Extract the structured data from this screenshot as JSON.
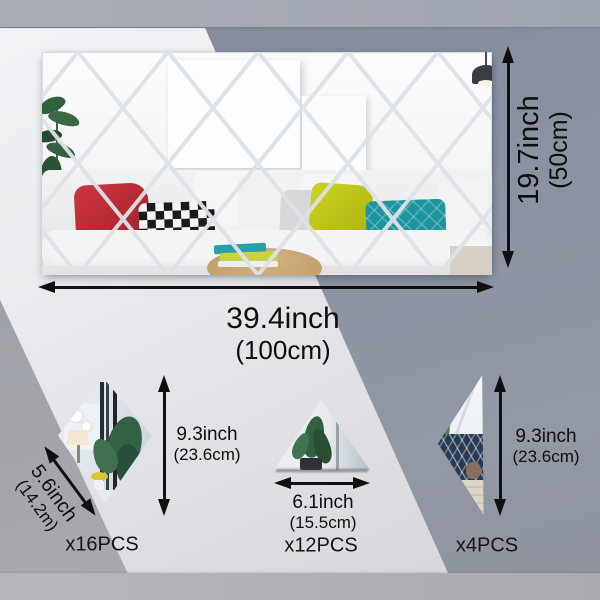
{
  "product": {
    "main_mirror": {
      "width_label": "39.4inch",
      "width_metric": "(100cm)",
      "height_label": "19.7inch",
      "height_metric": "(50cm)"
    },
    "pieces": [
      {
        "shape": "diamond",
        "edge_label": "5.6inch",
        "edge_metric": "(14.2m)",
        "height_label": "9.3inch",
        "height_metric": "(23.6cm)",
        "count": "x16PCS"
      },
      {
        "shape": "triangle",
        "base_label": "6.1inch",
        "base_metric": "(15.5cm)",
        "count": "x12PCS"
      },
      {
        "shape": "half-diamond",
        "height_label": "9.3inch",
        "height_metric": "(23.6cm)",
        "count": "x4PCS"
      }
    ]
  },
  "colors": {
    "bg_top_band": "#a7abb4",
    "bg_bottom_band": "#b0b2b6",
    "bg_light": "#e7e9ed",
    "bg_gray_blue": "#8b92a2",
    "bg_gray_wedge": "#9fa2a9",
    "seam": "#dde2e7",
    "arrow": "#101010",
    "pillow_red": "#c6313d",
    "pillow_yellow": "#ccd31f",
    "pillow_teal": "#1d95a0",
    "pillow_check_dark": "#1a1b1d",
    "plant_green": "#33603f"
  }
}
